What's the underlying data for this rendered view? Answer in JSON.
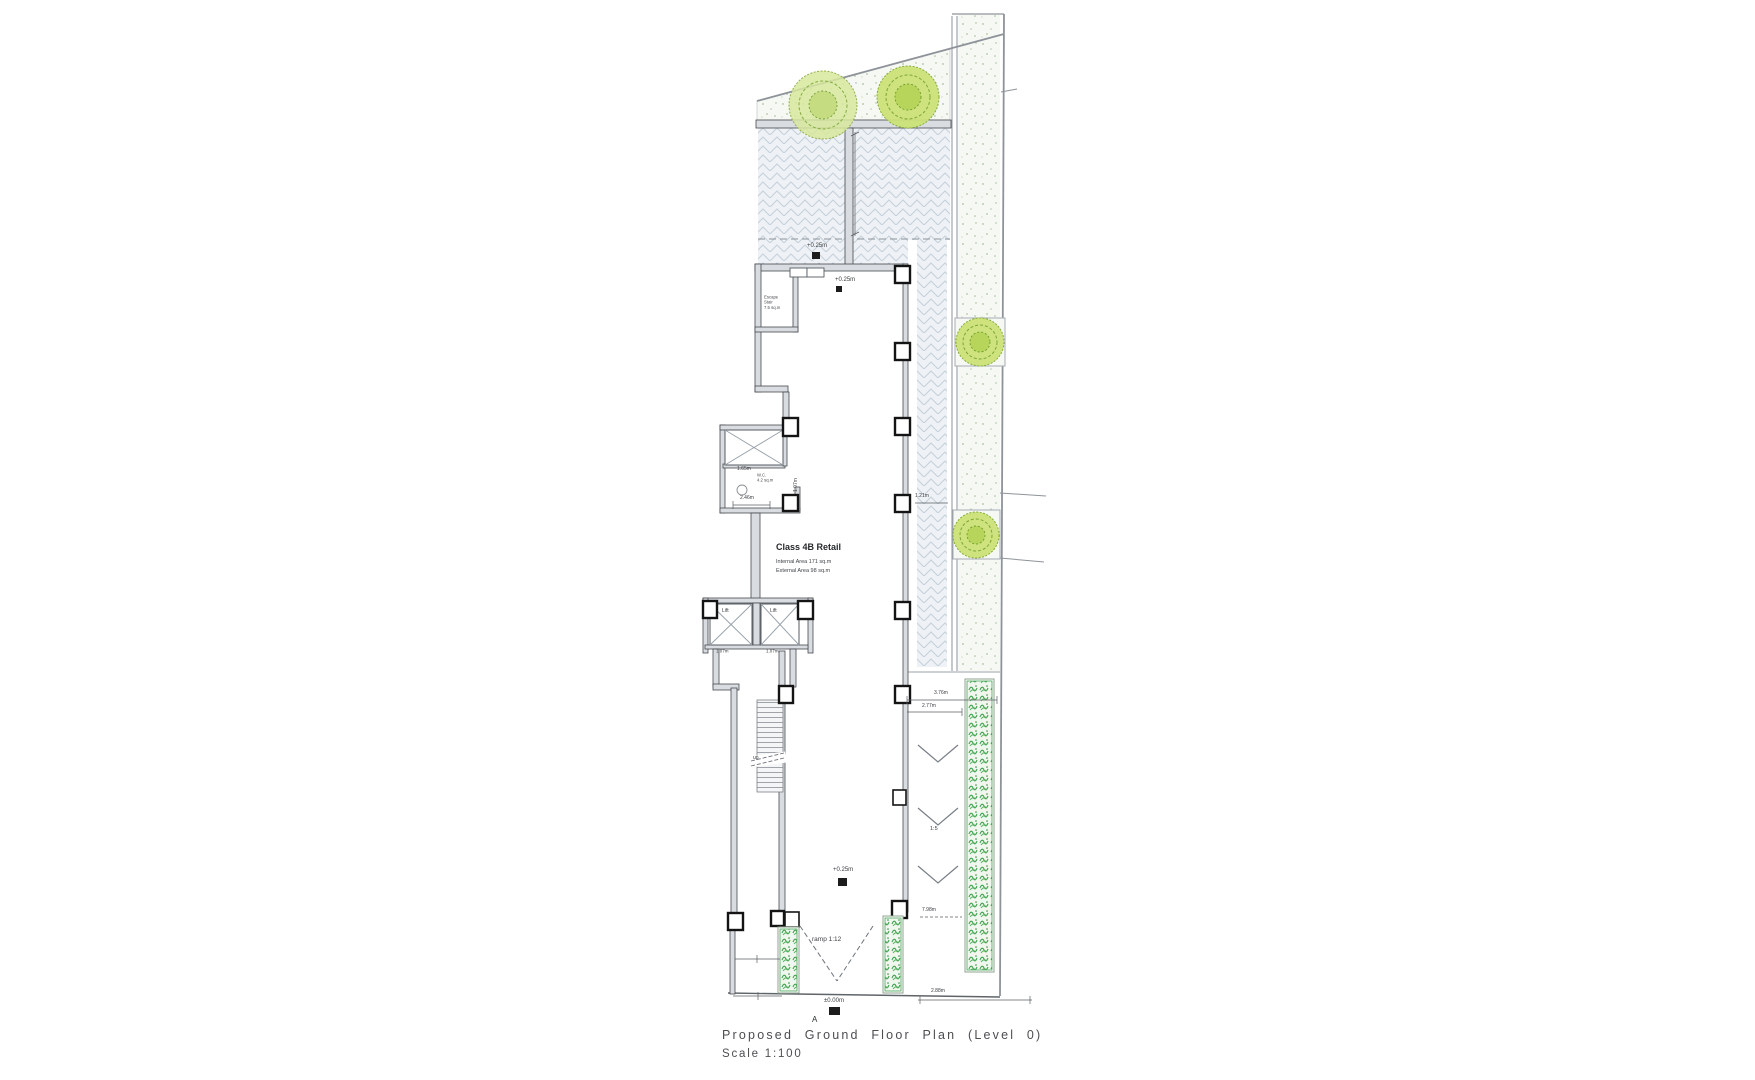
{
  "title": {
    "text": "Proposed Ground Floor Plan (Level 0)",
    "scale": "Scale 1:100",
    "section_marker": "A"
  },
  "retail_label": {
    "name": "Class 4B Retail",
    "internal": "Internal Area 171 sq.m",
    "external": "External Area 98 sq.m"
  },
  "rooms": {
    "escape": [
      "Escape",
      "Stair",
      "7.5 sq.m"
    ],
    "wc": [
      "W.C.",
      "4.2 sq.m"
    ],
    "lift_left": "Lift",
    "lift_right": "Lift",
    "stair_direction": "up"
  },
  "levels": {
    "courtyard": "+0.25m",
    "threshold": "+0.25m",
    "rear": "+0.25m",
    "entrance": "±0.00m"
  },
  "dimensions": {
    "lobby": "2.46m",
    "upper_lift": "1.65m",
    "lift_left": "1.07m",
    "lift_right": "1.07m",
    "lobby_door": "1.07m",
    "walkway": "1.21m",
    "car_ramp_a": "3.76m",
    "car_ramp_b": "2.77m",
    "car_ramp_gradient": "1:5",
    "entrance_ramp": "ramp 1:12",
    "forecourt": "7.98m",
    "site_edge": "2.88m"
  },
  "colors": {
    "wall_fill": "#d9dde1",
    "wall_edge": "#45494e",
    "column_edge": "#141414",
    "paving_hatch": "#c6d0da",
    "landscape_dot": "#aabf9e",
    "tree_green": "#9cc03f",
    "hedge_green": "#3ea24c",
    "dimension": "#5a5f64",
    "title_text": "#4c4e50"
  }
}
